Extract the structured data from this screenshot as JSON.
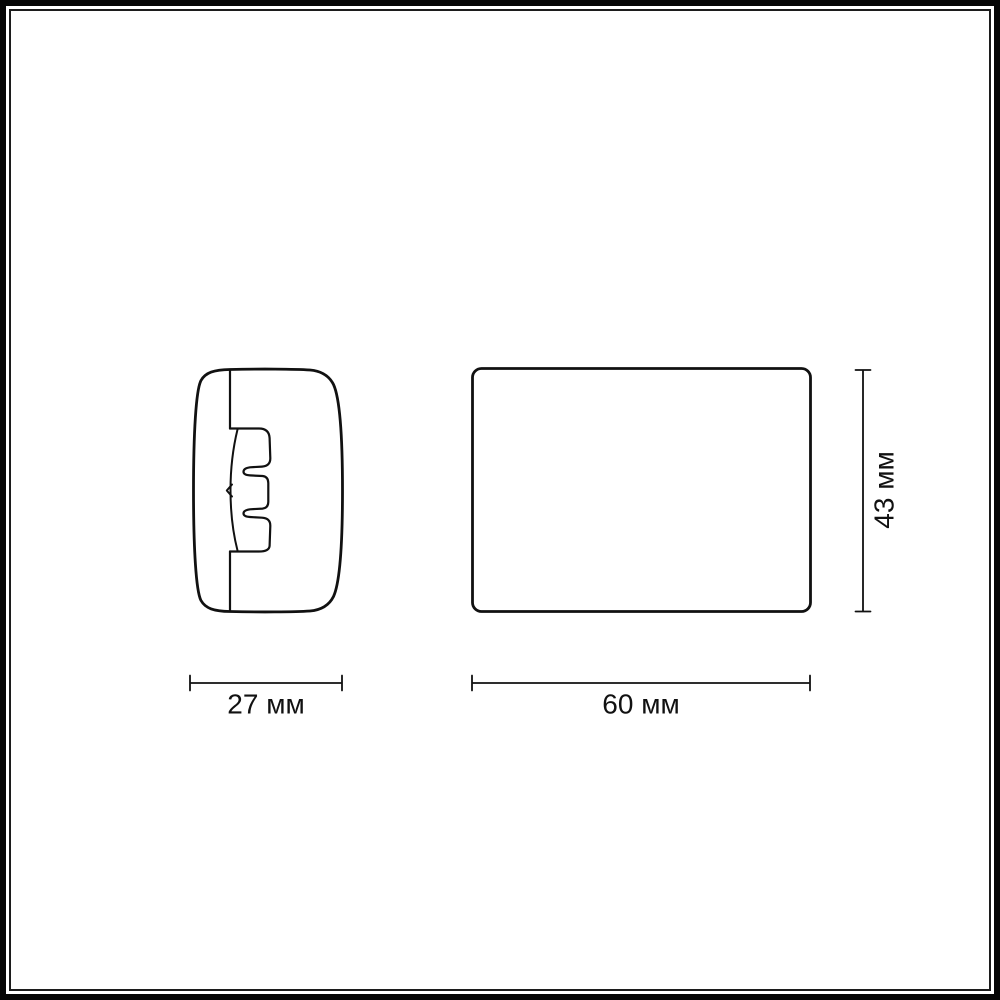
{
  "page": {
    "background_color": "#ffffff"
  },
  "frame": {
    "outer_border_color": "#060606",
    "inner_border_color": "#1c1c1c"
  },
  "drawing": {
    "line_color": "#111111",
    "dimensions": {
      "side_width": {
        "label": "27 мм",
        "value": "27",
        "unit": "мм"
      },
      "front_width": {
        "label": "60 мм",
        "value": "60",
        "unit": "мм"
      },
      "front_height": {
        "label": "43 мм",
        "value": "43",
        "unit": "мм"
      }
    }
  }
}
